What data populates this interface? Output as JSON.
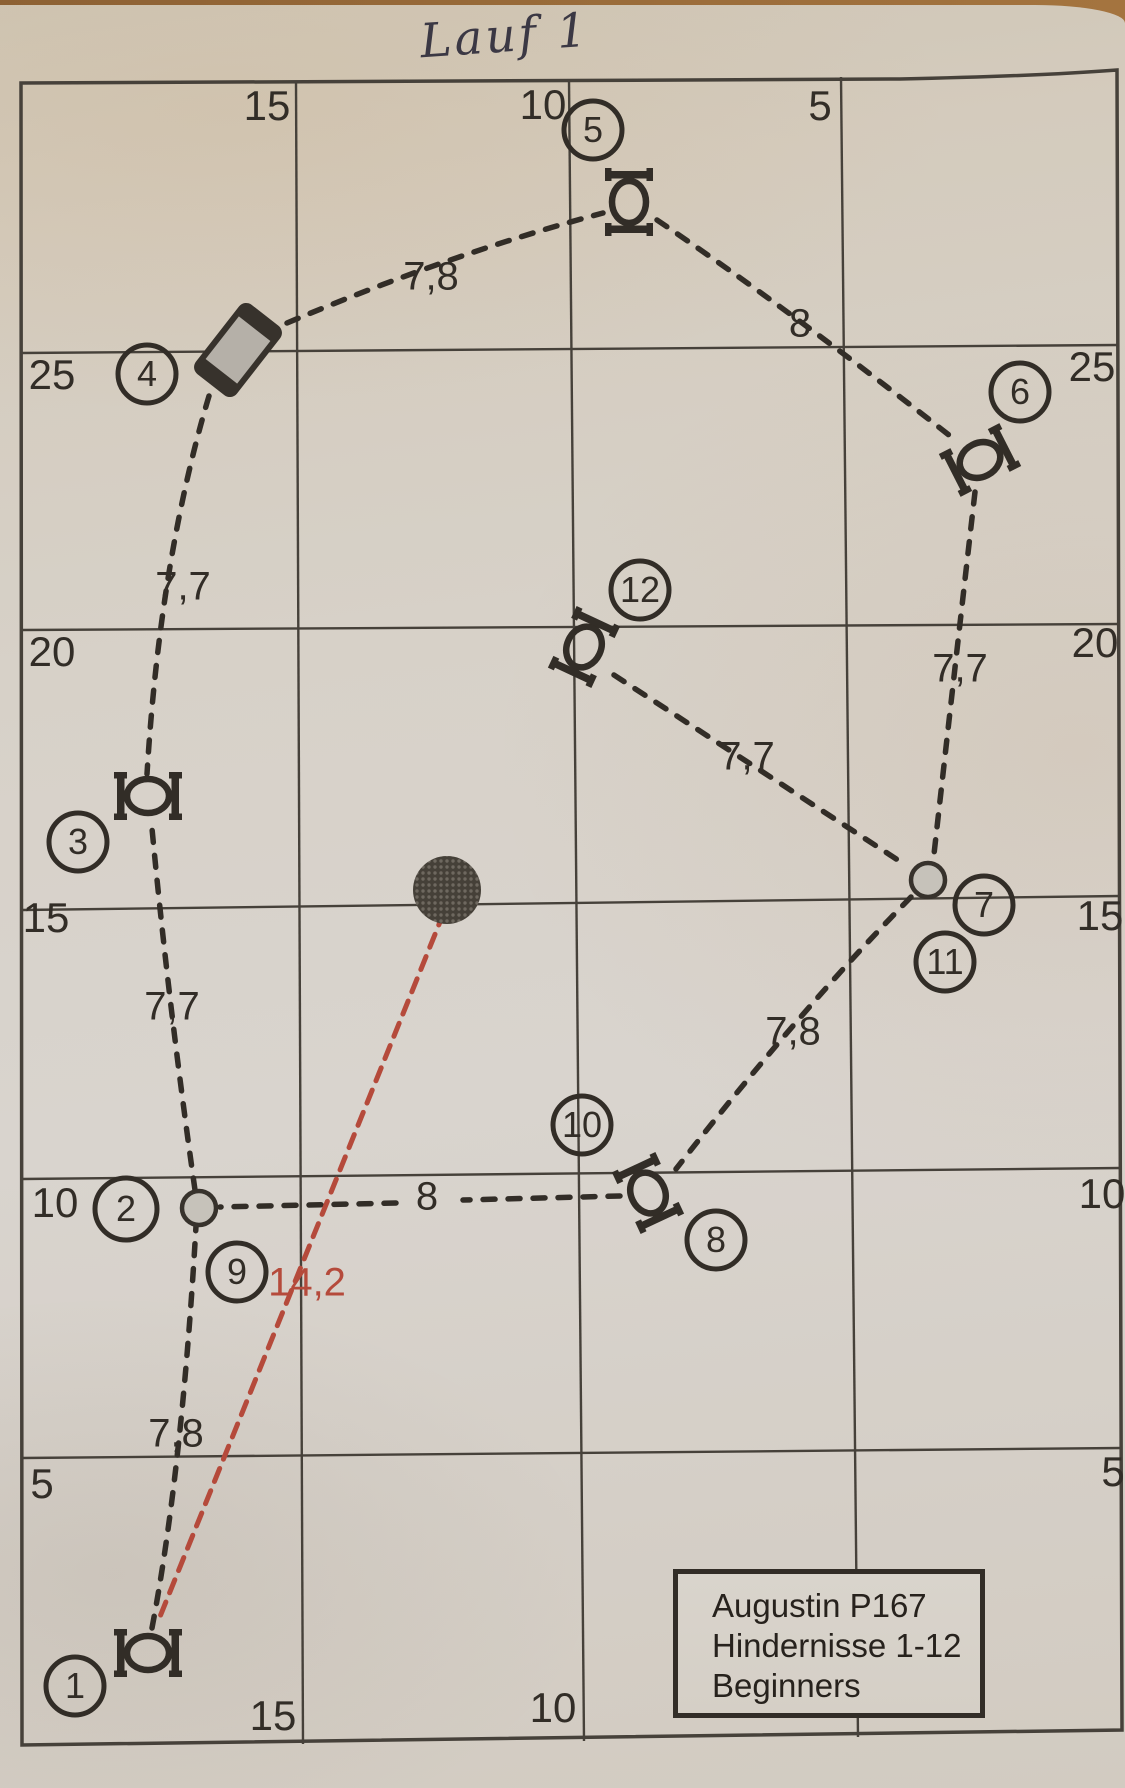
{
  "title": "Lauf 1",
  "info_box": {
    "line1": "Augustin P167",
    "line2": "Hindernisse 1-12",
    "line3": "Beginners"
  },
  "grid_labels": {
    "top": [
      "15",
      "10",
      "5"
    ],
    "bottom": [
      "15",
      "10"
    ],
    "left": [
      "25",
      "20",
      "15",
      "10",
      "5"
    ],
    "right": [
      "25",
      "20",
      "15",
      "10",
      "5"
    ]
  },
  "obstacles": [
    {
      "num": "1",
      "type": "hoop"
    },
    {
      "num": "2",
      "type": "gate-dot"
    },
    {
      "num": "3",
      "type": "hoop"
    },
    {
      "num": "4",
      "type": "barrel"
    },
    {
      "num": "5",
      "type": "hoop"
    },
    {
      "num": "6",
      "type": "hoop"
    },
    {
      "num": "7",
      "type": "gate-dot"
    },
    {
      "num": "8",
      "type": "hoop"
    },
    {
      "num": "9",
      "type": "gate-dot"
    },
    {
      "num": "10",
      "type": "hoop"
    },
    {
      "num": "11",
      "type": "gate-dot"
    },
    {
      "num": "12",
      "type": "hoop"
    }
  ],
  "distances": {
    "leg_1_2": "7,8",
    "leg_2_3": "7,7",
    "leg_3_4": "7,7",
    "leg_4_5": "7,8",
    "leg_5_6": "8",
    "leg_6_7": "7,7",
    "leg_7_8": "7,8",
    "leg_8_9": "8",
    "leg_11_12": "7,7",
    "measure": "14,2"
  },
  "colors": {
    "table_brown": "#96683a",
    "paper": "#d6d0c8",
    "ink": "#322d27",
    "grid_line": "#46413a",
    "measure_red": "#b54a3b",
    "barrel_gray": "#b5b0a8",
    "dot_gray": "#c6c2ba"
  }
}
